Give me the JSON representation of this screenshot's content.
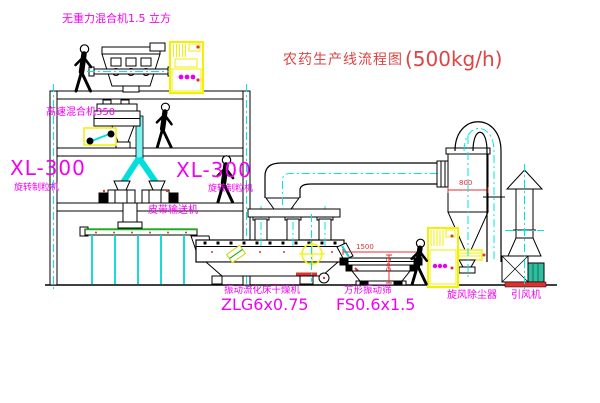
{
  "title": {
    "name": "农药生产线流程图",
    "capacity": "(500kg/h)"
  },
  "labels": {
    "gravity_mixer": "无重力混合机1.5 立方",
    "high_speed_mixer": "高速混合机350",
    "granulator_left_model": "XL-300",
    "granulator_left_name": "旋转制粒机",
    "granulator_right_model": "XL-300",
    "granulator_right_name": "旋转制粒机",
    "belt_conveyor": "皮带输送机",
    "dryer_name": "振动流化床干燥机",
    "dryer_model": "ZLG6x0.75",
    "sieve_name": "方形振动筛",
    "sieve_model": "FS0.6x1.5",
    "cyclone": "旋风除尘器",
    "fan": "引风机"
  },
  "dimensions": {
    "sieve_length": "1500",
    "sieve_height": "546",
    "cyclone_diameter": "800"
  },
  "colors": {
    "label_magenta": "#f200f2",
    "title_red": "#dd4444",
    "dimension_red": "#e03030",
    "centerline_cyan": "#00e5e5",
    "cabinet_yellow": "#f2f200",
    "belt_green": "#00c000",
    "outline_black": "#000000",
    "background": "#ffffff"
  }
}
